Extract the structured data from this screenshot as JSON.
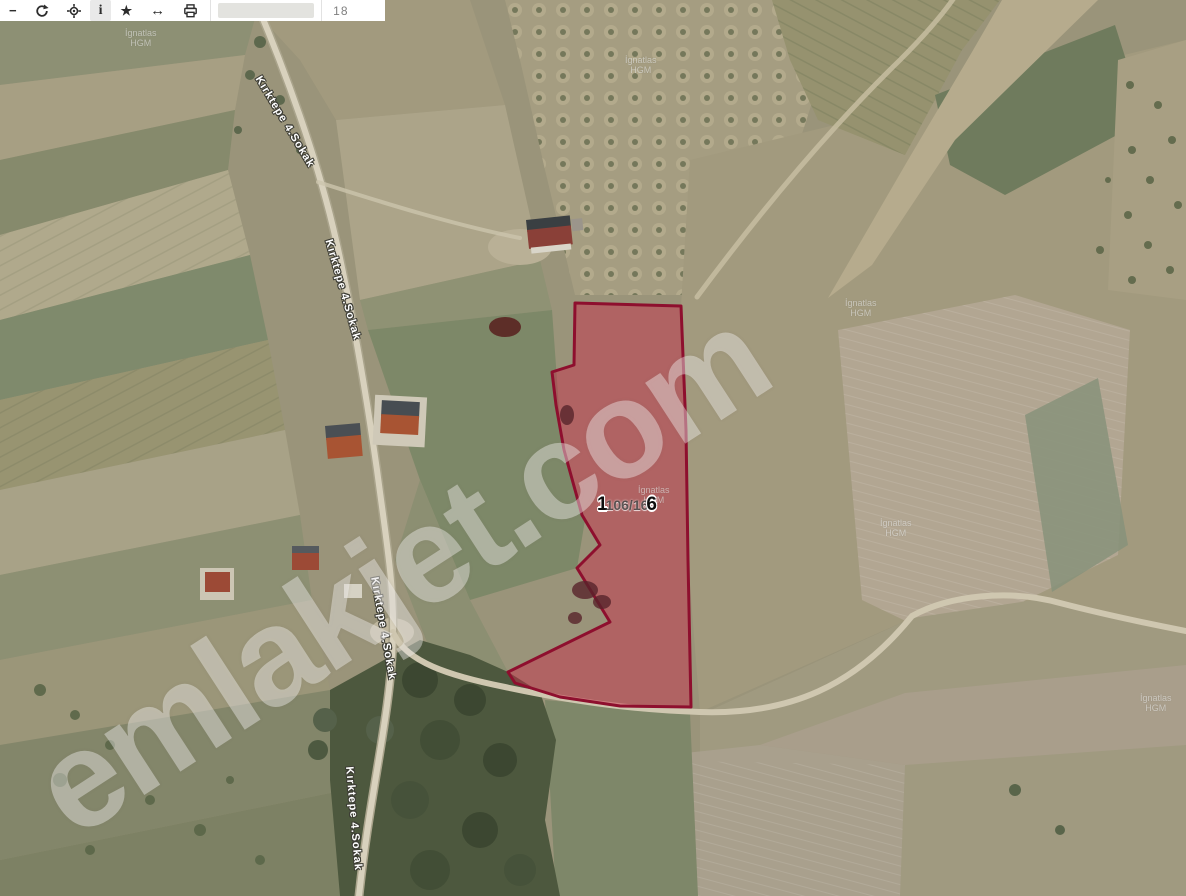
{
  "toolbar": {
    "tools": {
      "zoom_out": {
        "glyph": "−"
      },
      "refresh": {},
      "locate": {},
      "info": {
        "glyph": "i",
        "active": true
      },
      "favorite": {
        "glyph": "★"
      },
      "measure": {
        "glyph": "↔"
      },
      "print": {}
    },
    "plot_input": {
      "value": "",
      "placeholder": ""
    },
    "zoom_level": "18"
  },
  "map": {
    "parcel": {
      "number": "106/166",
      "label": {
        "bold_prefix": "1",
        "faded_middle": "106/16",
        "bold_suffix": "6"
      },
      "fill_color": "#cb2846",
      "stroke_color": "#8e0f2e"
    },
    "street_labels": [
      {
        "text": "Kırktepe 4.Sokak"
      },
      {
        "text": "Kırktepe 4.Sokak"
      },
      {
        "text": "Kırktepe 4.Sokak"
      },
      {
        "text": "Kırktepe 4.Sokak"
      }
    ],
    "imagery_watermark": {
      "line1": "İgnatlas",
      "line2": "HGM"
    },
    "site_watermark": "emlakjet.com"
  }
}
